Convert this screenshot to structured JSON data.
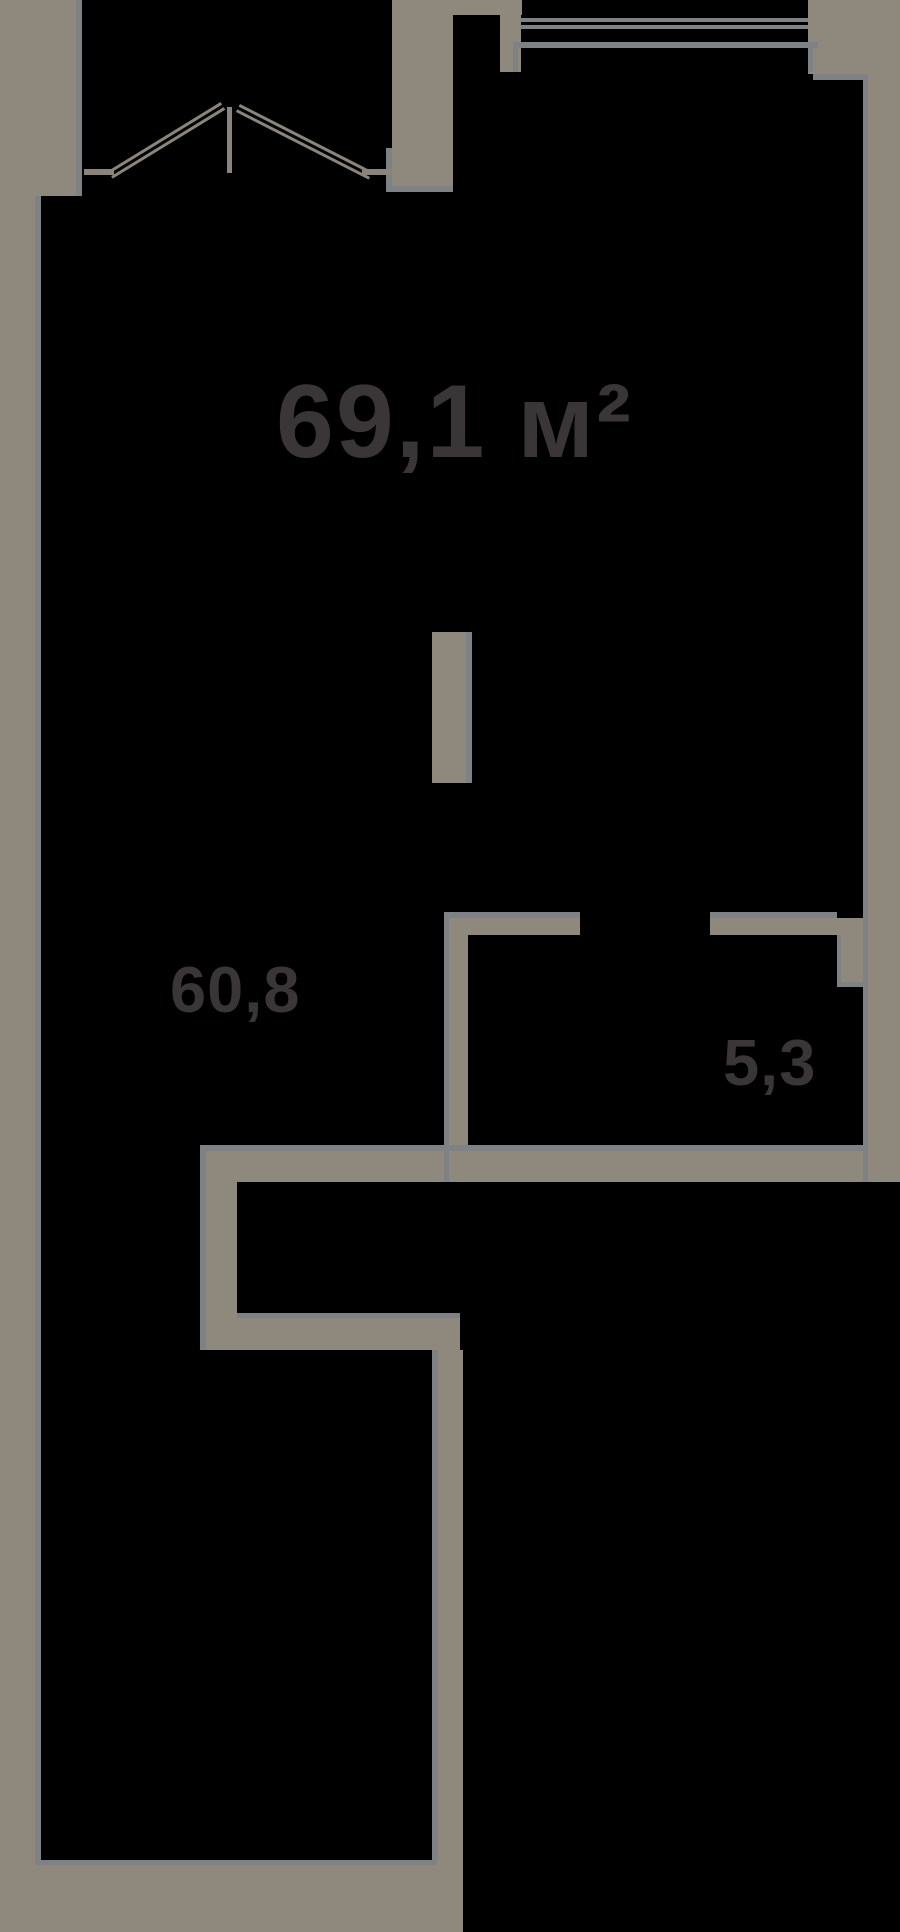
{
  "plan": {
    "total_area_label": "69,1 м²",
    "rooms": [
      {
        "name": "main-room",
        "area_label": "60,8"
      },
      {
        "name": "small-room",
        "area_label": "5,3"
      }
    ]
  },
  "colors": {
    "background": "#000000",
    "wall": "#8f887d",
    "edge": "#7f8285",
    "line": "#8a847b",
    "label": "#3a3536"
  }
}
